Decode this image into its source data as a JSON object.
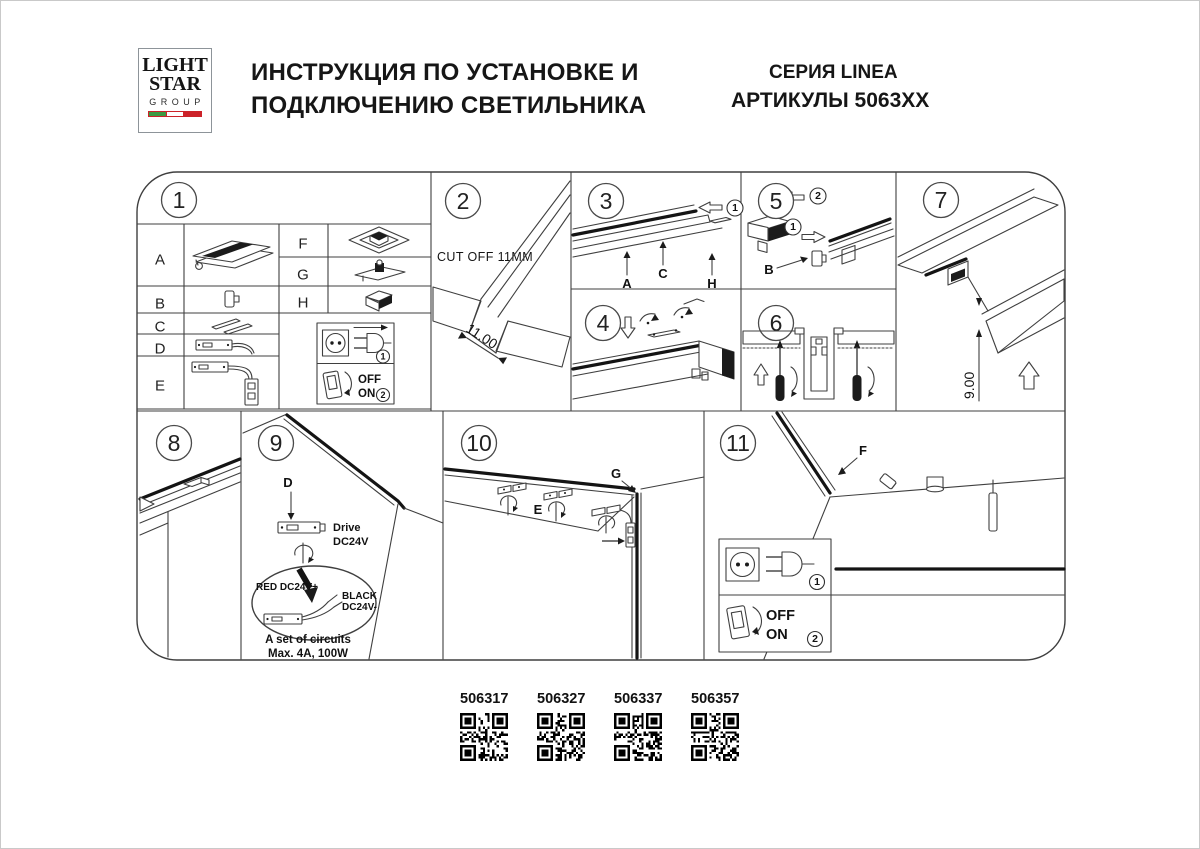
{
  "header": {
    "logo_line1": "LIGHT",
    "logo_line2": "STAR",
    "logo_line3": "GROUP",
    "logo_colors": {
      "flag_green": "#3d9a42",
      "flag_white": "#ffffff",
      "flag_red": "#cc2229"
    },
    "title_line1": "ИНСТРУКЦИЯ ПО УСТАНОВКЕ И",
    "title_line2": "ПОДКЛЮЧЕНИЮ СВЕТИЛЬНИКА",
    "series": "СЕРИЯ LINEA",
    "articles": "АРТИКУЛЫ 5063XX"
  },
  "panels": {
    "p1": {
      "number": "1",
      "row_labels": [
        "A",
        "B",
        "C",
        "D",
        "E"
      ],
      "right_labels": [
        "F",
        "G",
        "H"
      ]
    },
    "p2": {
      "number": "2",
      "cut_off": "CUT OFF 11MM",
      "dimension": "11.00"
    },
    "p3": {
      "number": "3",
      "step_1": "1",
      "step_2": "2",
      "label_a": "A",
      "label_c": "C",
      "label_h": "H"
    },
    "p4": {
      "number": "4"
    },
    "p5": {
      "number": "5",
      "step_1": "1",
      "label_b": "B"
    },
    "p6": {
      "number": "6"
    },
    "p7": {
      "number": "7",
      "dimension": "9.00"
    },
    "p8": {
      "number": "8"
    },
    "p9": {
      "number": "9",
      "label_d": "D",
      "driver_line1": "Drive",
      "driver_line2": "DC24V",
      "wire_red": "RED DC24V+",
      "wire_black_line1": "BLACK",
      "wire_black_line2": "DC24V-",
      "circuits_line1": "A set of circuits",
      "circuits_line2": "Max. 4A, 100W"
    },
    "p10": {
      "number": "10",
      "label_e": "E",
      "label_g": "G"
    },
    "p11": {
      "number": "11",
      "label_f": "F"
    }
  },
  "legend": {
    "plug_step": "1",
    "switch_step": "2",
    "off_label": "OFF",
    "on_label": "ON"
  },
  "qr": {
    "codes": [
      "506317",
      "506327",
      "506337",
      "506357"
    ]
  }
}
